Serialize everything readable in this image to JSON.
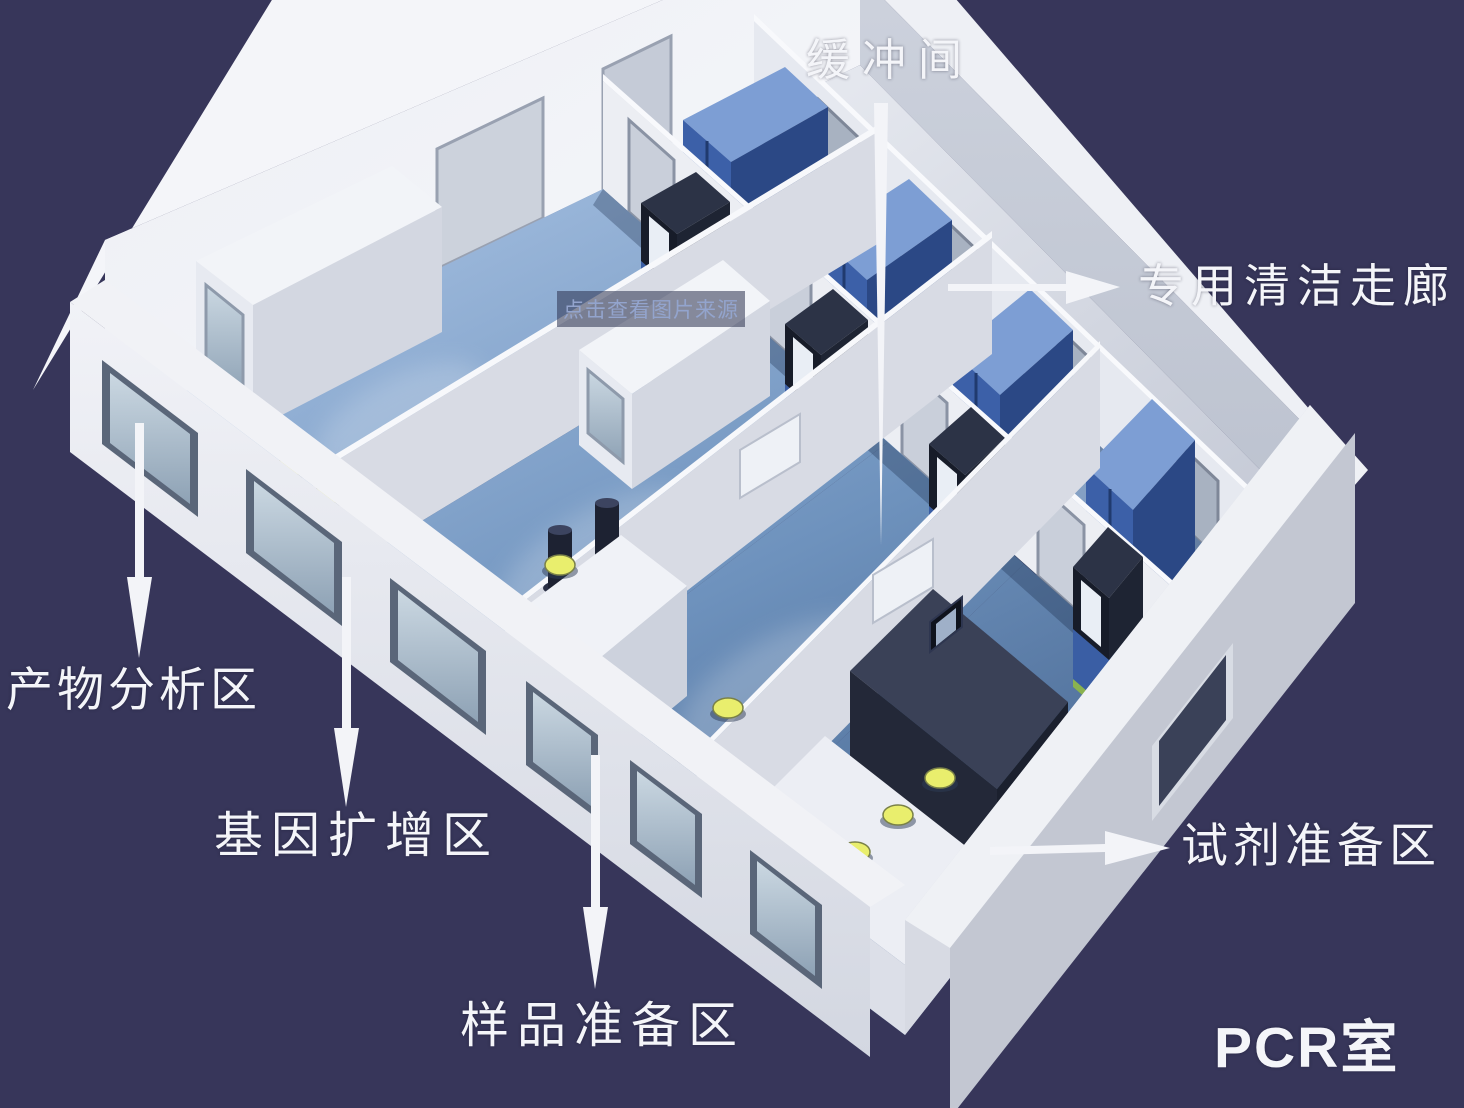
{
  "labels": {
    "buffer_room": "缓冲间",
    "clean_corridor": "专用清洁走廊",
    "product_analysis_area": "产物分析区",
    "gene_amplification_area": "基因扩增区",
    "sample_preparation_area": "样品准备区",
    "reagent_preparation_area": "试剂准备区",
    "pcr_room": "PCR室"
  },
  "watermark": {
    "text": "点击查看图片来源"
  },
  "colors": {
    "background": "#37365a",
    "wall_white": "#eef0f5",
    "wall_shadow": "#c6cbd6",
    "floor_blue": "#6f93bf",
    "corridor_floor": "#d3d7e0",
    "cabinet_blue": "#3c60a8",
    "pass_box_frame": "#171b26",
    "stool_yellow": "#e9ee6d",
    "accent_green": "#8ab24f",
    "label_text": "#f4f5f9",
    "watermark_text": "#93a4cd"
  }
}
